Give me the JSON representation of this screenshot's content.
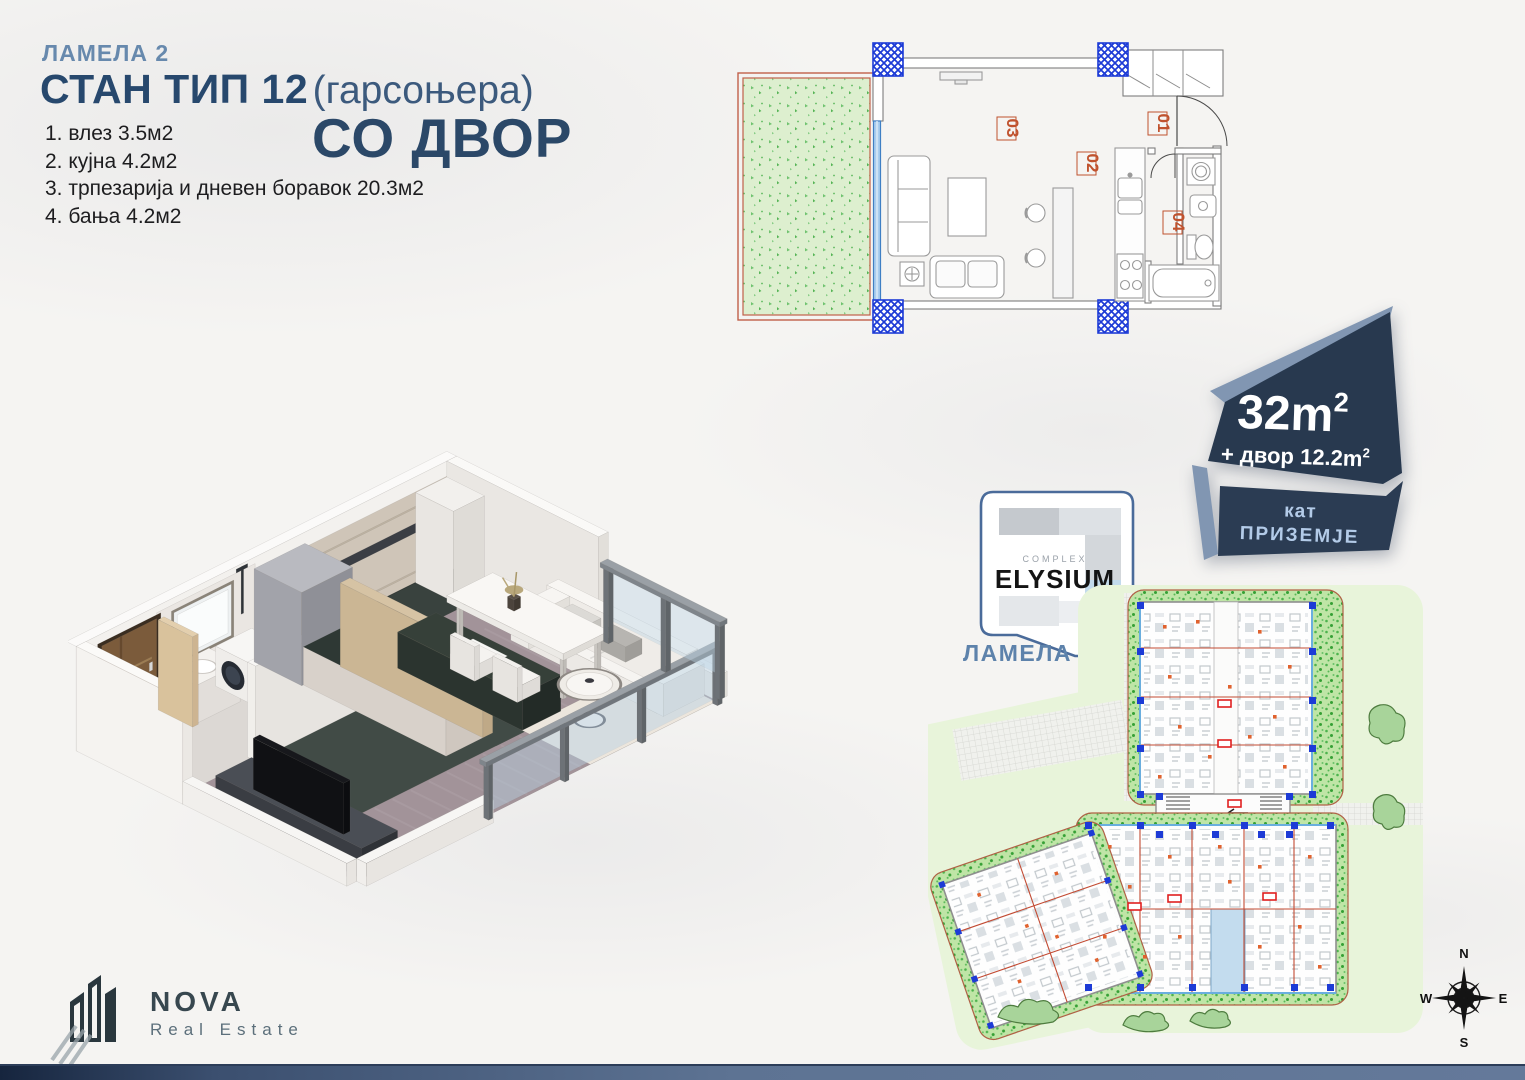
{
  "page": {
    "background": "#f5f4f2",
    "footer_left": "#16253e",
    "footer_right": "#64799a"
  },
  "header": {
    "lamela": "ЛАМЕЛА 2",
    "title_bold": "СТАН ТИП 12",
    "title_light": " (гарсоњера)",
    "highlight": "СО ДВОР",
    "rooms": [
      "1. влез 3.5м2",
      "2. кујна 4.2м2",
      "3. трпезарија и дневен боравок 20.3м2",
      "4. бања 4.2м2"
    ]
  },
  "badge": {
    "bg": "#28394f",
    "bevel": "#8196b2",
    "accent": "#b3cbe8",
    "area_value": "32m",
    "area_sup": "2",
    "yard_value": "+ двор 12.2m",
    "yard_sup": "2",
    "floor_label": "кат",
    "floor_value": "ПРИЗЕМЈЕ"
  },
  "complex_logo": {
    "label": "COMPLEX",
    "name": "ELYSIUM",
    "lamela": "ЛАМЕЛА 2",
    "border_color": "#4a6b9a"
  },
  "floorplan": {
    "labels": [
      "01",
      "02",
      "03",
      "04"
    ],
    "column_color": "#1d3bd6",
    "grass_color": "#ddefcf",
    "label_color": "#c0522e",
    "window_color": "#a9cdee",
    "yard_border": "#c0604a"
  },
  "siteplan": {
    "highlight_color": "#c3dcee",
    "greenery": "#6ec16e",
    "column_color": "#1d3bd6",
    "dot_color": "#e0622e"
  },
  "compass": {
    "n": "N",
    "e": "E",
    "s": "S",
    "w": "W"
  },
  "brand": {
    "name": "NOVA",
    "tagline": "Real Estate"
  }
}
